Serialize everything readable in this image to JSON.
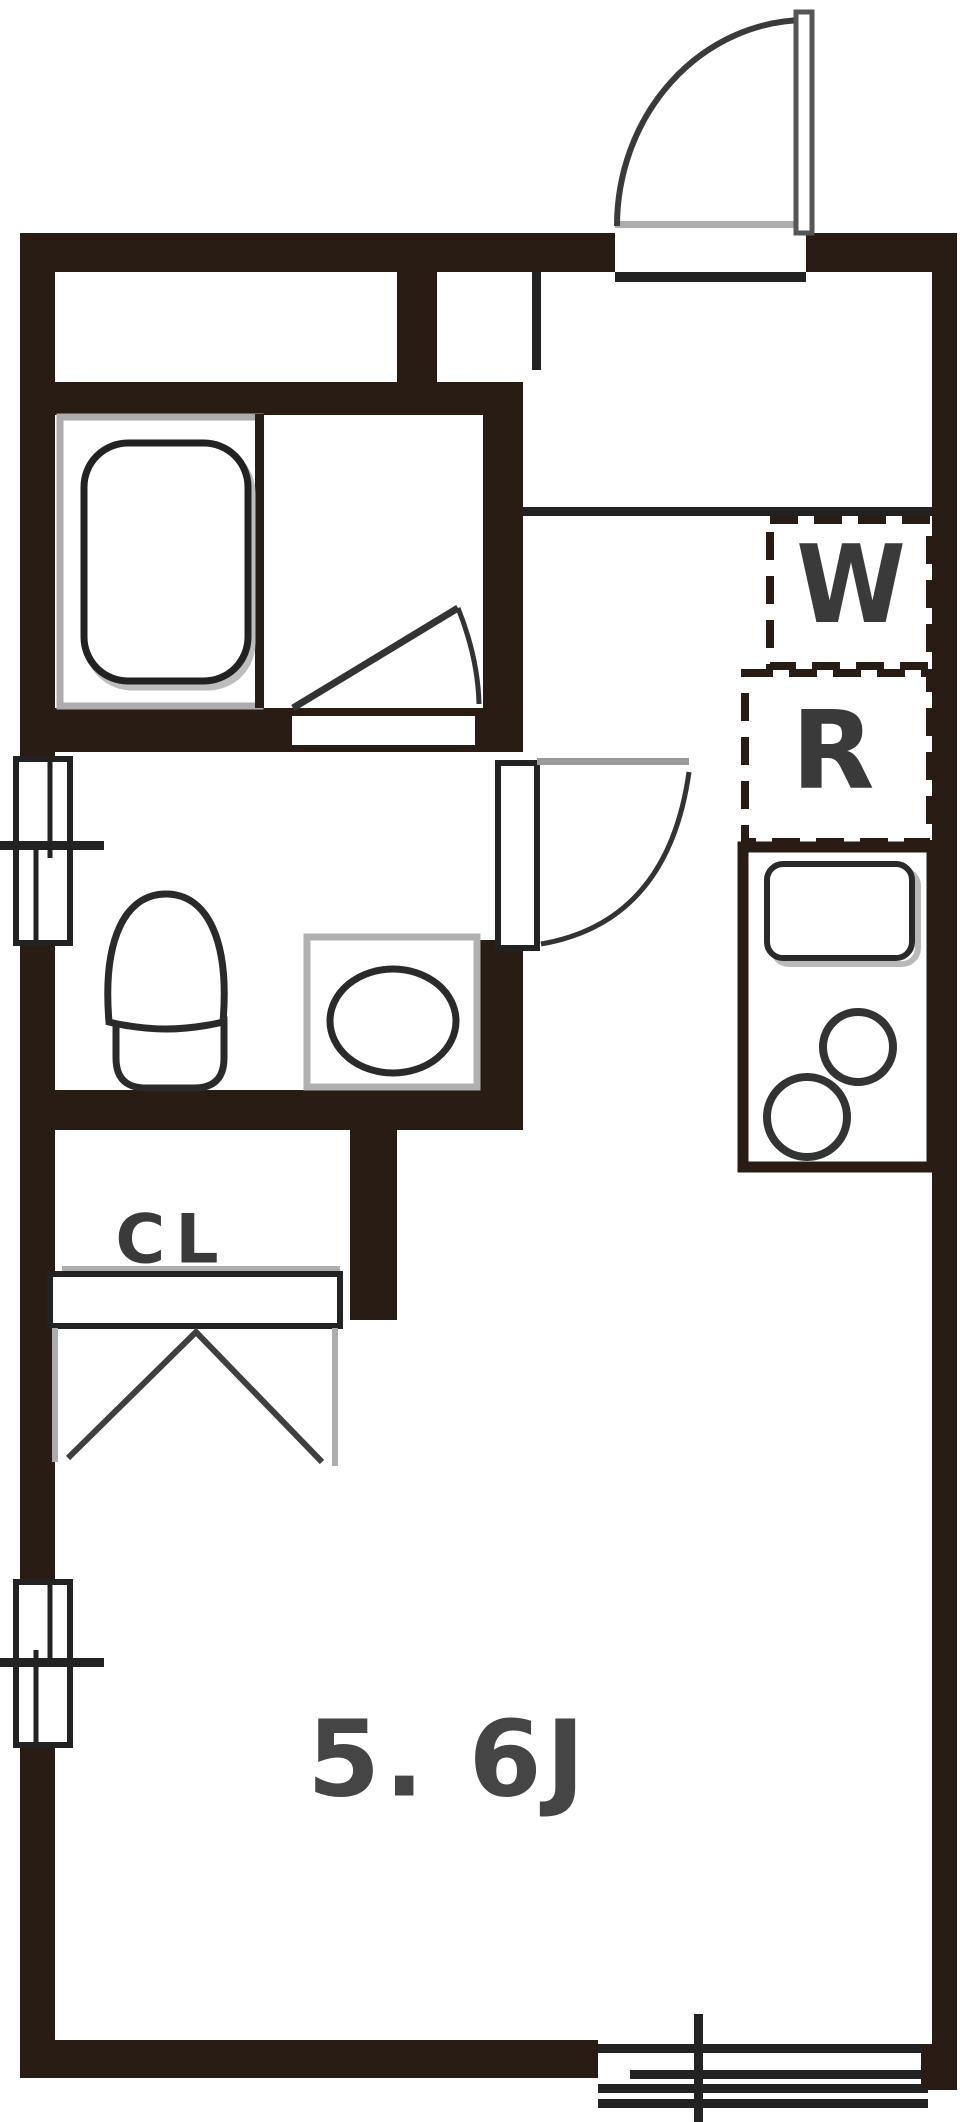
{
  "labels": {
    "washer": "W",
    "refrigerator": "R",
    "closet": "CL",
    "main_room": "5. 6J"
  },
  "colors": {
    "wall": "#281c14",
    "line": "#222222",
    "gray": "#adadad",
    "label_text": "#3a3a3a"
  }
}
